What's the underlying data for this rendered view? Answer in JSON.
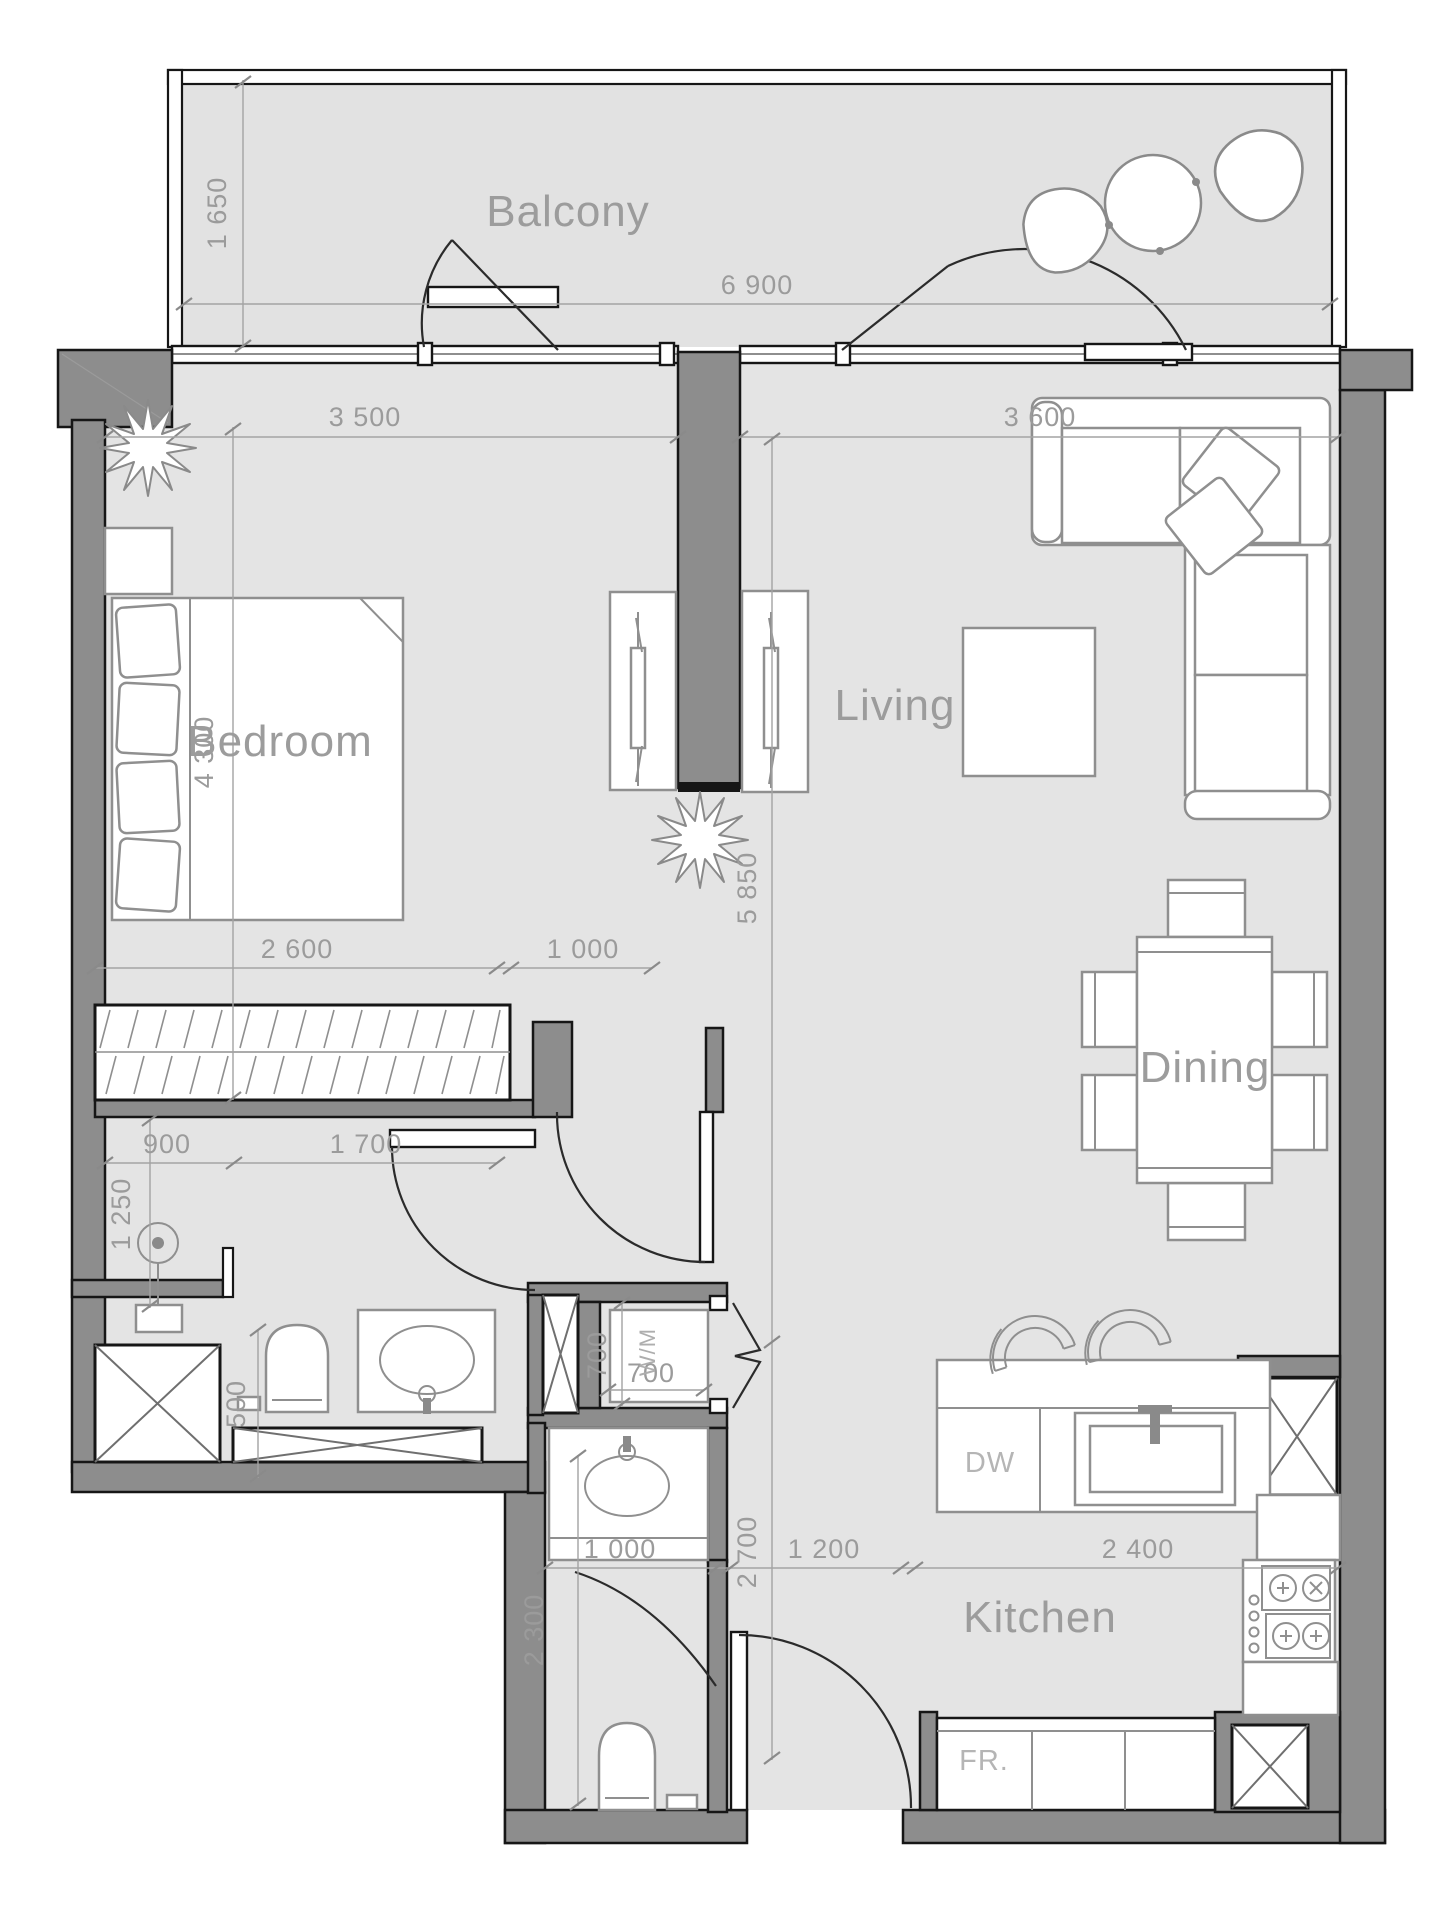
{
  "rooms": {
    "balcony": "Balcony",
    "bedroom": "Bedroom",
    "living": "Living",
    "dining": "Dining",
    "kitchen": "Kitchen"
  },
  "appliances": {
    "dishwasher": "DW",
    "fridge": "FR.",
    "washing_machine": "W/M"
  },
  "dims": {
    "balcony_depth": "1 650",
    "balcony_width": "6 900",
    "bedroom_width": "3 500",
    "living_width": "3 600",
    "bedroom_depth": "4 300",
    "living_depth": "5 850",
    "wardrobe_width": "2 600",
    "wardrobe_gap": "1 000",
    "hall_left": "900",
    "hall_right": "1 700",
    "bath_lobby": "1 250",
    "bath_clear": "500",
    "wm_depth": "700",
    "wm_width": "700",
    "kitchen_depth": "2 700",
    "entry_left": "1 000",
    "entry_mid": "1 200",
    "kitchen_run": "2 400",
    "wc_depth": "2 300"
  },
  "colors": {
    "wall": "#8d8d8d",
    "outline": "#161616",
    "floor": "#e4e4e4",
    "balcony_floor": "#e2e2e2",
    "furniture_stroke": "#8f8f8f",
    "dimension": "#9b9b9b",
    "label": "#9c9c9c"
  }
}
